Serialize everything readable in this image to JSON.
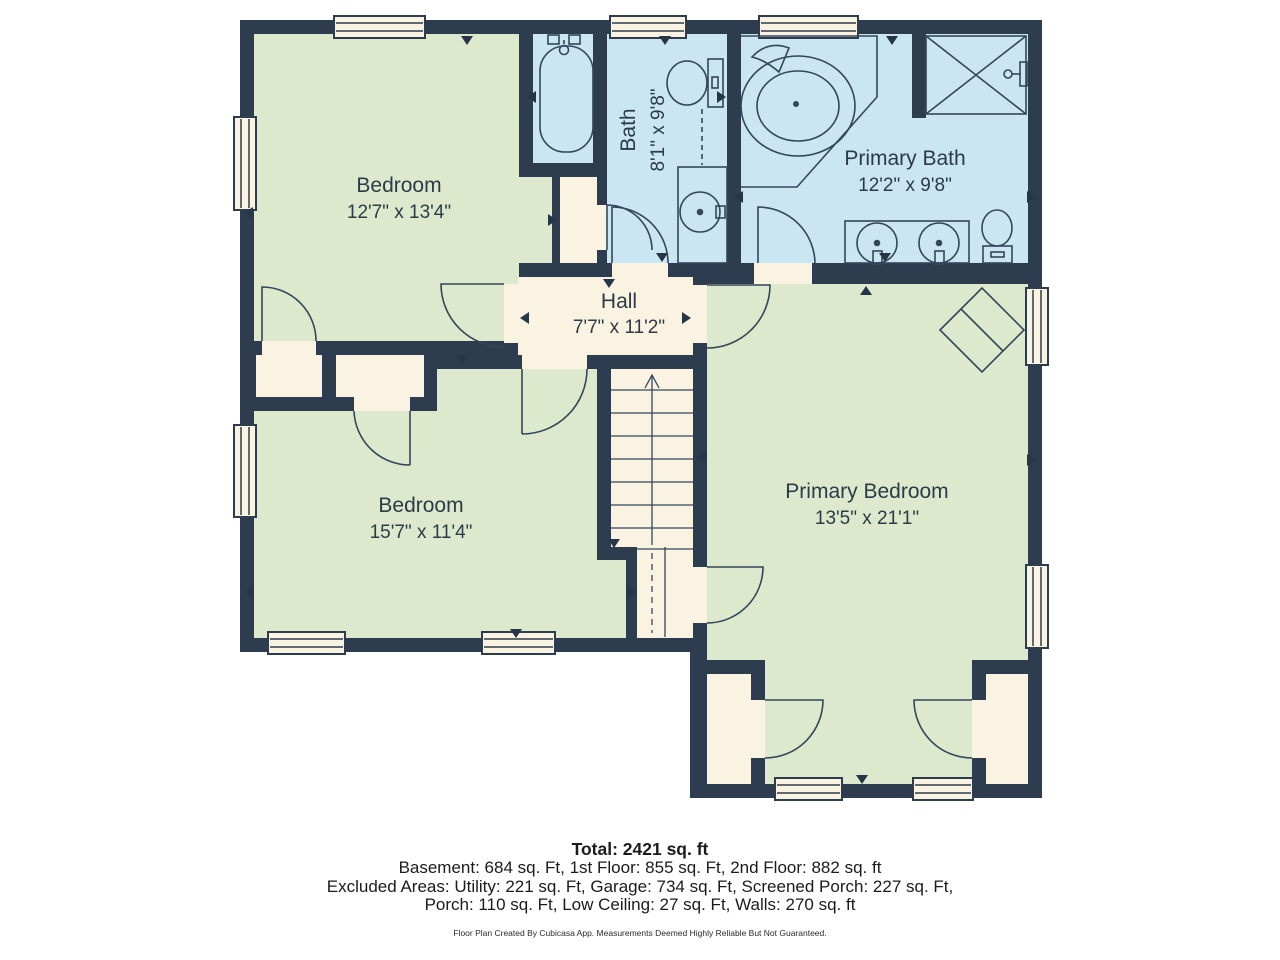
{
  "palette": {
    "wall": "#2d3c4e",
    "room_green": "#dde9cc",
    "room_blue": "#c9e6f2",
    "room_cream": "#faf3e1",
    "background": "#ffffff",
    "label_text": "#2c3a49"
  },
  "rooms": [
    {
      "id": "bedroom_tl",
      "name": "Bedroom",
      "dimensions": "12'7\" x 13'4\""
    },
    {
      "id": "bath",
      "name": "Bath",
      "dimensions": "8'1\" x 9'8\""
    },
    {
      "id": "primary_bath",
      "name": "Primary Bath",
      "dimensions": "12'2\" x 9'8\""
    },
    {
      "id": "hall",
      "name": "Hall",
      "dimensions": "7'7\" x 11'2\""
    },
    {
      "id": "bedroom_ll",
      "name": "Bedroom",
      "dimensions": "15'7\" x 11'4\""
    },
    {
      "id": "primary_bedroom",
      "name": "Primary Bedroom",
      "dimensions": "13'5\" x 21'1\""
    }
  ],
  "summary": {
    "total": "Total: 2421 sq. ft",
    "line2": "Basement: 684 sq. Ft, 1st Floor: 855 sq. Ft, 2nd Floor: 882 sq. ft",
    "line3": "Excluded Areas: Utility: 221 sq. Ft, Garage: 734 sq. Ft, Screened Porch: 227 sq. Ft,",
    "line4": "Porch: 110 sq. Ft, Low Ceiling: 27 sq. Ft, Walls: 270 sq. ft",
    "disclaimer": "Floor Plan Created By Cubicasa App. Measurements Deemed Highly Reliable But Not Guaranteed."
  }
}
